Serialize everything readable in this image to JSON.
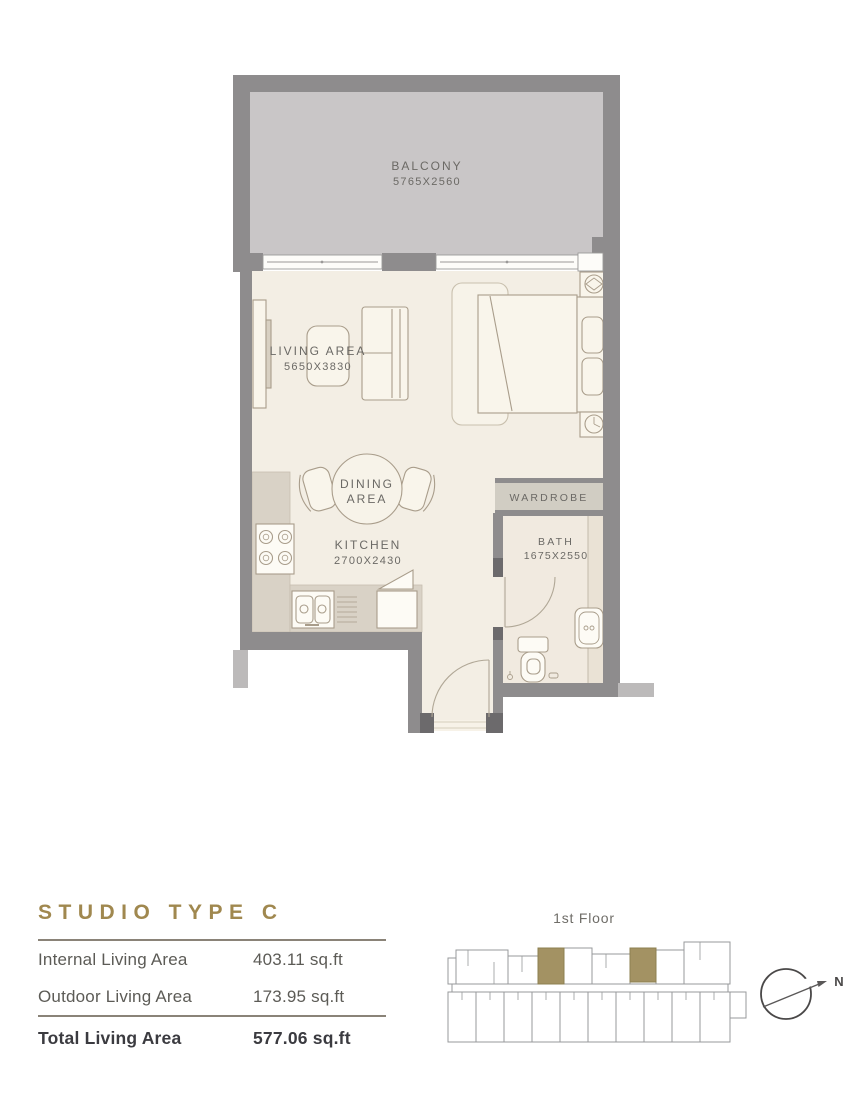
{
  "floor_plan": {
    "balcony": {
      "label": "BALCONY",
      "dims": "5765X2560"
    },
    "living_area": {
      "label": "LIVING AREA",
      "dims": "5650X3830"
    },
    "dining_area": {
      "label_line1": "DINING",
      "label_line2": "AREA"
    },
    "kitchen": {
      "label": "KITCHEN",
      "dims": "2700X2430"
    },
    "wardrobe": {
      "label": "WARDROBE"
    },
    "bath": {
      "label": "BATH",
      "dims": "1675X2550"
    }
  },
  "unit_details": {
    "title": "STUDIO TYPE C",
    "rows": [
      {
        "label": "Internal Living Area",
        "value": "403.11 sq.ft"
      },
      {
        "label": "Outdoor Living Area",
        "value": "173.95 sq.ft"
      }
    ],
    "total": {
      "label": "Total Living Area",
      "value": "577.06 sq.ft"
    }
  },
  "key_plan": {
    "floor_label": "1st Floor",
    "compass_label": "N"
  },
  "colors": {
    "wall": "#8e8c8d",
    "wall_dark_post": "#6c6a6c",
    "neighbor_wall": "#bcbaba",
    "balcony_floor": "#c9c6c7",
    "interior_floor": "#f3eee4",
    "bath_floor": "#f1eae0",
    "counter": "#d9d2c6",
    "wardrobe_fill": "#d1cdc3",
    "accent_gold": "#a0884f",
    "key_highlight": "#a39263",
    "label_gray": "#6b6965"
  }
}
